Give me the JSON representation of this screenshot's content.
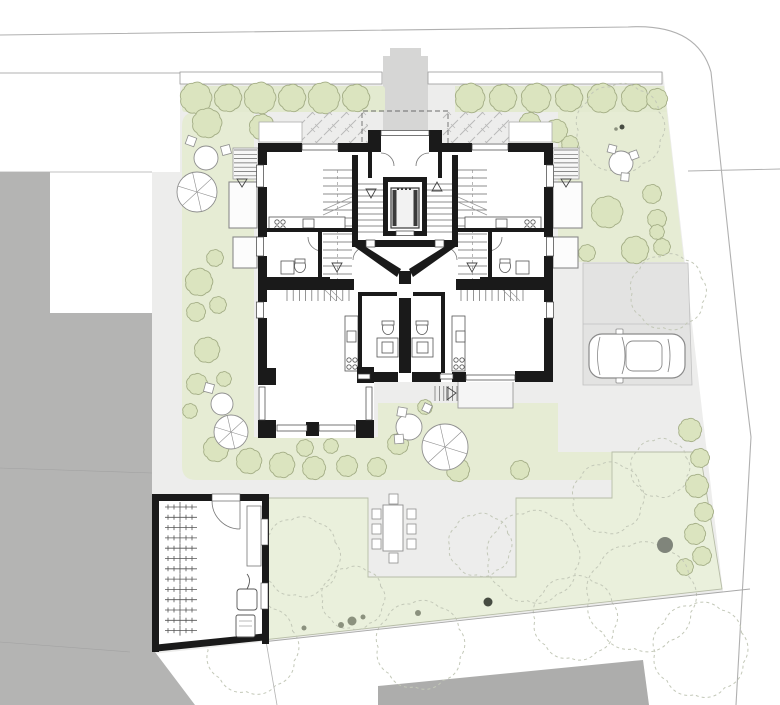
{
  "meta": {
    "drawing_type": "architectural site plan with ground floor plan",
    "has_text_labels": false
  },
  "colors": {
    "background": "#ffffff",
    "siteBase": "#ededec",
    "walkway": "#d6d6d5",
    "parking": "#e3e3e2",
    "parkingLine": "#bfbfbf",
    "gardenGreen": "#e6ecd4",
    "lawnGreen": "#eaf0dc",
    "lawnEdge": "#b7bda7",
    "hedgeStrip": "#e3ead0",
    "treeFill": "#dbe4bf",
    "treeStroke": "#a4ae86",
    "neighborBuilding": "#b4b4b3",
    "neighborBuildingSouth": "#adadac",
    "wallBlack": "#1a1a1a",
    "thinLine": "#4a4a4a",
    "boundaryLine": "#a9a9a9",
    "furnitureStroke": "#8f8f8f",
    "canopyDash": "#c3c8b8",
    "shrubDark": "#474c42",
    "shrubMed": "#8b917e",
    "existingTreeTrunk": "#80857b",
    "slabFill": "#f5f5f5"
  },
  "site": {
    "parking_space_count": 2,
    "car_count": 1,
    "apartment_wings": 2,
    "entrance_columns": 2
  },
  "bikeRoom": {
    "bike_count": 13
  },
  "landscape": {
    "hedge_left": [
      [
        196,
        98,
        15
      ],
      [
        228,
        98,
        13
      ],
      [
        260,
        98,
        15
      ],
      [
        292,
        98,
        13
      ],
      [
        324,
        98,
        15
      ],
      [
        356,
        98,
        13
      ]
    ],
    "hedge_right": [
      [
        470,
        98,
        14
      ],
      [
        503,
        98,
        13
      ],
      [
        536,
        98,
        14
      ],
      [
        569,
        98,
        13
      ],
      [
        602,
        98,
        14
      ],
      [
        635,
        98,
        13
      ],
      [
        657,
        99,
        10
      ]
    ],
    "trees": [
      [
        207,
        123,
        14
      ],
      [
        262,
        127,
        12
      ],
      [
        199,
        282,
        13
      ],
      [
        215,
        258,
        8
      ],
      [
        196,
        312,
        9
      ],
      [
        218,
        305,
        8
      ],
      [
        207,
        350,
        12
      ],
      [
        197,
        384,
        10
      ],
      [
        224,
        379,
        7
      ],
      [
        190,
        411,
        7
      ],
      [
        216,
        449,
        12
      ],
      [
        249,
        461,
        12
      ],
      [
        282,
        465,
        12
      ],
      [
        314,
        468,
        11
      ],
      [
        347,
        466,
        10
      ],
      [
        377,
        467,
        9
      ],
      [
        305,
        448,
        8
      ],
      [
        331,
        446,
        7
      ],
      [
        398,
        444,
        10
      ],
      [
        425,
        407,
        7
      ],
      [
        458,
        470,
        11
      ],
      [
        520,
        470,
        9
      ],
      [
        530,
        123,
        10
      ],
      [
        556,
        131,
        11
      ],
      [
        570,
        144,
        8
      ],
      [
        607,
        212,
        15
      ],
      [
        652,
        194,
        9
      ],
      [
        657,
        219,
        9
      ],
      [
        635,
        250,
        13
      ],
      [
        662,
        247,
        8
      ],
      [
        587,
        253,
        8
      ],
      [
        657,
        232,
        7
      ]
    ],
    "bushes_right_edge": [
      [
        690,
        430,
        11
      ],
      [
        700,
        458,
        9
      ],
      [
        697,
        486,
        11
      ],
      [
        704,
        512,
        9
      ],
      [
        695,
        534,
        10
      ],
      [
        702,
        556,
        9
      ],
      [
        685,
        567,
        8
      ]
    ],
    "dashed_canopies": [
      [
        620,
        128,
        42
      ],
      [
        668,
        292,
        36
      ],
      [
        300,
        557,
        38
      ],
      [
        353,
        598,
        30
      ],
      [
        252,
        648,
        44
      ],
      [
        420,
        645,
        42
      ],
      [
        480,
        545,
        30
      ],
      [
        533,
        557,
        44
      ],
      [
        575,
        618,
        40
      ],
      [
        641,
        597,
        52
      ],
      [
        700,
        650,
        45
      ],
      [
        608,
        498,
        34
      ],
      [
        660,
        468,
        28
      ]
    ],
    "shrub_dots": [
      [
        304,
        628,
        2.5,
        "med"
      ],
      [
        341,
        625,
        3,
        "med"
      ],
      [
        352,
        621,
        4.5,
        "med"
      ],
      [
        363,
        617,
        2.5,
        "med"
      ],
      [
        418,
        613,
        3,
        "med"
      ],
      [
        488,
        602,
        4.5,
        "dark"
      ],
      [
        265,
        614,
        2,
        "med"
      ],
      [
        622,
        127,
        2.5,
        "dark"
      ],
      [
        616,
        129,
        1.8,
        "med"
      ]
    ],
    "existing_tree": [
      665,
      545,
      8
    ]
  },
  "furniture": {
    "parasols": [
      [
        197,
        192,
        20
      ],
      [
        231,
        432,
        17
      ],
      [
        445,
        447,
        23
      ]
    ],
    "round_tables": [
      [
        206,
        158,
        12
      ],
      [
        222,
        404,
        11
      ],
      [
        409,
        427,
        13
      ],
      [
        621,
        163,
        12
      ]
    ],
    "chairs": [
      [
        191,
        141,
        9,
        20
      ],
      [
        226,
        150,
        9,
        -15
      ],
      [
        209,
        388,
        9,
        15
      ],
      [
        402,
        412,
        9,
        10
      ],
      [
        399,
        439,
        9,
        -5
      ],
      [
        427,
        408,
        8,
        25
      ],
      [
        612,
        149,
        8,
        15
      ],
      [
        634,
        155,
        8,
        -20
      ],
      [
        625,
        177,
        8,
        5
      ]
    ],
    "dining_table": {
      "x": 383,
      "y": 505,
      "w": 20,
      "h": 46,
      "chairs": [
        [
          372,
          509
        ],
        [
          372,
          524
        ],
        [
          372,
          539
        ],
        [
          407,
          509
        ],
        [
          407,
          524
        ],
        [
          407,
          539
        ],
        [
          389,
          494
        ],
        [
          389,
          553
        ]
      ]
    }
  }
}
